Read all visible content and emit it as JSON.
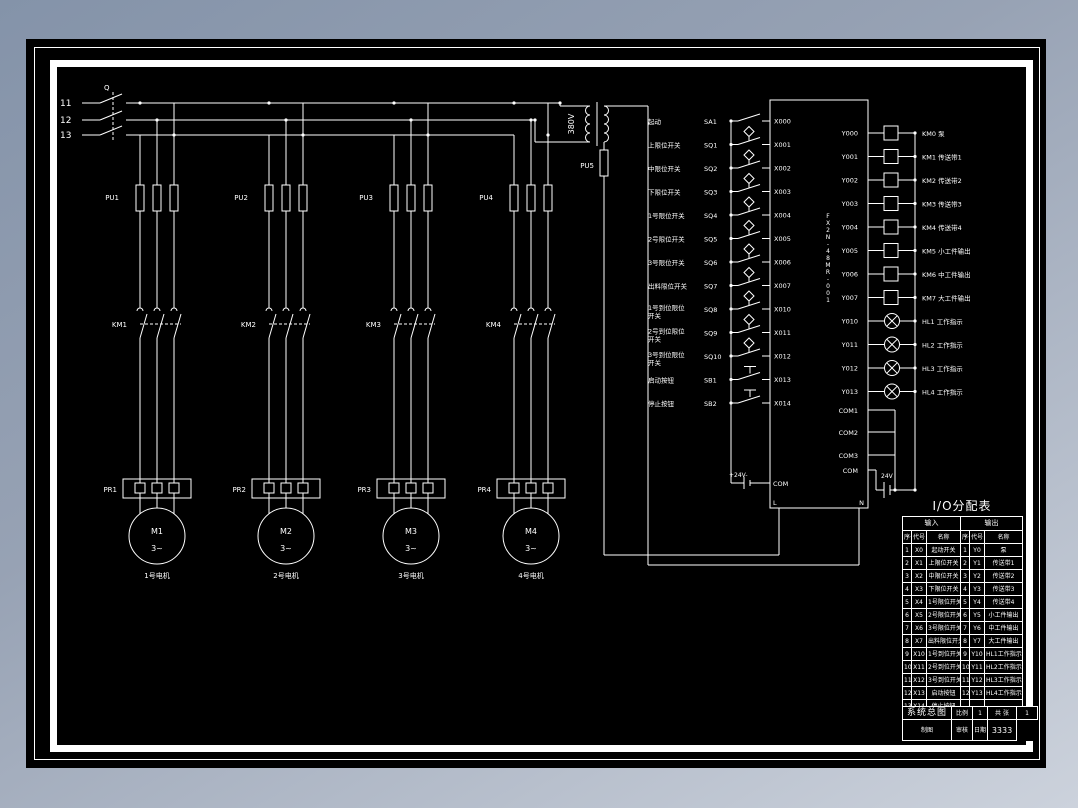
{
  "colors": {
    "backdrop_top": "#8493a9",
    "backdrop_bottom": "#ccd2dc",
    "paper": "#000000",
    "line": "#ffffff"
  },
  "power": {
    "phase_labels": [
      "11",
      "12",
      "13"
    ],
    "switch_label": "Q",
    "transformer_voltage": "380V",
    "control_fuse": "PU5"
  },
  "branches": [
    {
      "fuse": "PU1",
      "contactor": "KM1",
      "relay": "PR1",
      "motor": "M1",
      "motor_phase": "3~",
      "caption": "1号电机"
    },
    {
      "fuse": "PU2",
      "contactor": "KM2",
      "relay": "PR2",
      "motor": "M2",
      "motor_phase": "3~",
      "caption": "2号电机"
    },
    {
      "fuse": "PU3",
      "contactor": "KM3",
      "relay": "PR3",
      "motor": "M3",
      "motor_phase": "3~",
      "caption": "3号电机"
    },
    {
      "fuse": "PU4",
      "contactor": "KM4",
      "relay": "PR4",
      "motor": "M4",
      "motor_phase": "3~",
      "caption": "4号电机"
    }
  ],
  "plc": {
    "model": "FX2N-48MR-001",
    "supply_label": "+24V-",
    "com_label": "COM",
    "line_terminal": "L",
    "neutral_terminal": "N",
    "battery_label": "24V",
    "com_terminals": [
      "COM1",
      "COM2",
      "COM3",
      "COM"
    ],
    "inputs": [
      {
        "label": "起动",
        "device": "SA1",
        "addr": "X000",
        "sym": "switch"
      },
      {
        "label": "上限位开关",
        "device": "SQ1",
        "addr": "X001",
        "sym": "limit"
      },
      {
        "label": "中限位开关",
        "device": "SQ2",
        "addr": "X002",
        "sym": "limit"
      },
      {
        "label": "下限位开关",
        "device": "SQ3",
        "addr": "X003",
        "sym": "limit"
      },
      {
        "label": "1号限位开关",
        "device": "SQ4",
        "addr": "X004",
        "sym": "limit"
      },
      {
        "label": "2号限位开关",
        "device": "SQ5",
        "addr": "X005",
        "sym": "limit"
      },
      {
        "label": "3号限位开关",
        "device": "SQ6",
        "addr": "X006",
        "sym": "limit"
      },
      {
        "label": "出料限位开关",
        "device": "SQ7",
        "addr": "X007",
        "sym": "limit"
      },
      {
        "label": "1号到位限位开关",
        "device": "SQ8",
        "addr": "X010",
        "sym": "limit"
      },
      {
        "label": "2号到位限位开关",
        "device": "SQ9",
        "addr": "X011",
        "sym": "limit"
      },
      {
        "label": "3号到位限位开关",
        "device": "SQ10",
        "addr": "X012",
        "sym": "limit"
      },
      {
        "label": "启动按钮",
        "device": "SB1",
        "addr": "X013",
        "sym": "button"
      },
      {
        "label": "停止按钮",
        "device": "SB2",
        "addr": "X014",
        "sym": "button"
      }
    ],
    "outputs": [
      {
        "addr": "Y000",
        "dev": "coil",
        "label": "KM0 泵"
      },
      {
        "addr": "Y001",
        "dev": "coil",
        "label": "KM1 传送带1"
      },
      {
        "addr": "Y002",
        "dev": "coil",
        "label": "KM2 传送带2"
      },
      {
        "addr": "Y003",
        "dev": "coil",
        "label": "KM3 传送带3"
      },
      {
        "addr": "Y004",
        "dev": "coil",
        "label": "KM4 传送带4"
      },
      {
        "addr": "Y005",
        "dev": "coil",
        "label": "KM5 小工件输出"
      },
      {
        "addr": "Y006",
        "dev": "coil",
        "label": "KM6 中工件输出"
      },
      {
        "addr": "Y007",
        "dev": "coil",
        "label": "KM7 大工件输出"
      },
      {
        "addr": "Y010",
        "dev": "lamp",
        "label": "HL1 工作指示"
      },
      {
        "addr": "Y011",
        "dev": "lamp",
        "label": "HL2 工作指示"
      },
      {
        "addr": "Y012",
        "dev": "lamp",
        "label": "HL3 工作指示"
      },
      {
        "addr": "Y013",
        "dev": "lamp",
        "label": "HL4 工作指示"
      }
    ]
  },
  "io_table": {
    "title": "I/O分配表",
    "input_header": "输入",
    "output_header": "输出",
    "columns": [
      "序号",
      "代号",
      "名称"
    ],
    "input_rows": [
      [
        "1",
        "X0",
        "起动开关"
      ],
      [
        "2",
        "X1",
        "上限位开关"
      ],
      [
        "3",
        "X2",
        "中限位开关"
      ],
      [
        "4",
        "X3",
        "下限位开关"
      ],
      [
        "5",
        "X4",
        "1号限位开关"
      ],
      [
        "6",
        "X5",
        "2号限位开关"
      ],
      [
        "7",
        "X6",
        "3号限位开关"
      ],
      [
        "8",
        "X7",
        "出料限位开关"
      ],
      [
        "9",
        "X10",
        "1号到位开关"
      ],
      [
        "10",
        "X11",
        "2号到位开关"
      ],
      [
        "11",
        "X12",
        "3号到位开关"
      ],
      [
        "12",
        "X13",
        "启动按钮"
      ],
      [
        "13",
        "X14",
        "停止按钮"
      ]
    ],
    "output_rows": [
      [
        "1",
        "Y0",
        "泵"
      ],
      [
        "2",
        "Y1",
        "传送带1"
      ],
      [
        "3",
        "Y2",
        "传送带2"
      ],
      [
        "4",
        "Y3",
        "传送带3"
      ],
      [
        "5",
        "Y4",
        "传送带4"
      ],
      [
        "6",
        "Y5",
        "小工件输出"
      ],
      [
        "7",
        "Y6",
        "中工件输出"
      ],
      [
        "8",
        "Y7",
        "大工件输出"
      ],
      [
        "9",
        "Y10",
        "HL1工作指示"
      ],
      [
        "10",
        "Y11",
        "HL2工作指示"
      ],
      [
        "11",
        "Y12",
        "HL3工作指示"
      ],
      [
        "12",
        "Y13",
        "HL4工作指示"
      ],
      [
        "",
        "",
        ""
      ]
    ]
  },
  "title_block": {
    "title": "系统总图",
    "scale_label": "比例",
    "scale_value": "1",
    "sheet_label": "共 张",
    "sheet_value": "1",
    "drawn_label": "制图",
    "check_label": "审核",
    "date_label": "日期",
    "number": "3333"
  }
}
